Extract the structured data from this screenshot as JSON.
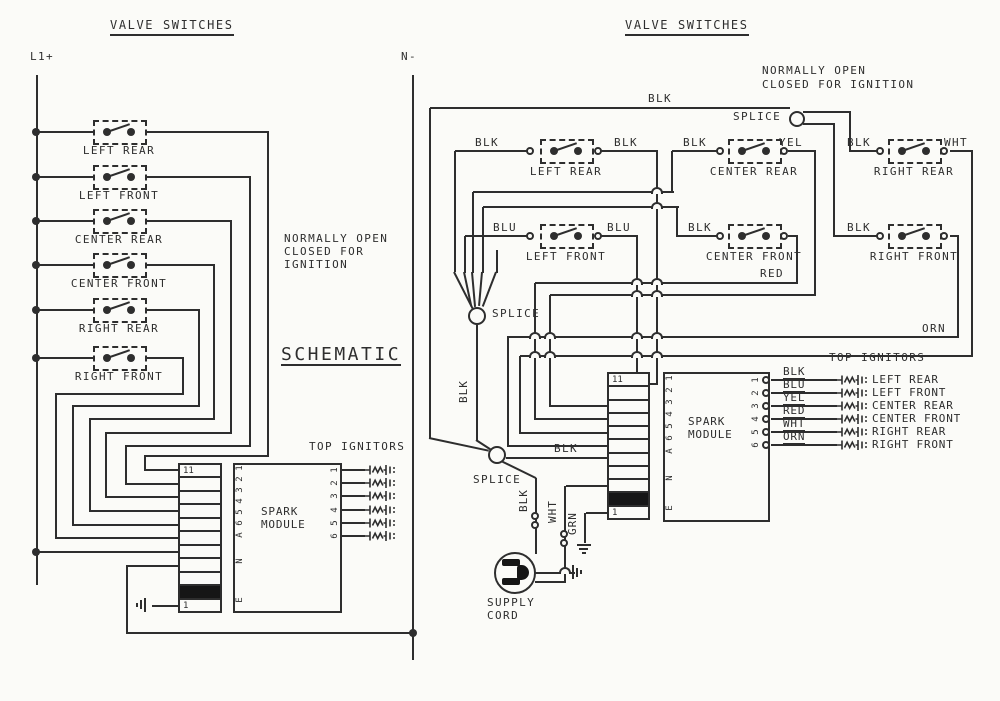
{
  "colors": {
    "line": "#2e2e2e",
    "background": "#fbfbf8",
    "connector_block": "#161616"
  },
  "left": {
    "title": "VALVE SWITCHES",
    "rail_left": "L1+",
    "rail_right": "N-",
    "switches": [
      "LEFT REAR",
      "LEFT FRONT",
      "CENTER REAR",
      "CENTER FRONT",
      "RIGHT REAR",
      "RIGHT FRONT"
    ],
    "note": [
      "NORMALLY OPEN",
      "CLOSED FOR",
      "IGNITION"
    ],
    "heading": "SCHEMATIC",
    "top_ignitors": "TOP IGNITORS",
    "connector": {
      "top": "11",
      "bottom": "1"
    },
    "module": {
      "line1": "SPARK",
      "line2": "MODULE",
      "pins_left": [
        "1",
        "2",
        "3",
        "4",
        "5",
        "6",
        "A",
        "N",
        "E"
      ],
      "pins_right": [
        "1",
        "2",
        "3",
        "4",
        "5",
        "6"
      ]
    }
  },
  "right": {
    "title": "VALVE SWITCHES",
    "note": [
      "NORMALLY OPEN",
      "CLOSED FOR IGNITION"
    ],
    "splice_label": "SPLICE",
    "switches": [
      {
        "name": "LEFT REAR",
        "left_wire": "BLK",
        "right_wire": "BLK"
      },
      {
        "name": "CENTER REAR",
        "left_wire": "BLK",
        "right_wire": "YEL"
      },
      {
        "name": "RIGHT REAR",
        "left_wire": "BLK",
        "right_wire": "WHT"
      },
      {
        "name": "LEFT FRONT",
        "left_wire": "BLU",
        "right_wire": "BLU"
      },
      {
        "name": "CENTER FRONT",
        "left_wire": "BLK",
        "right_wire": "RED"
      },
      {
        "name": "RIGHT FRONT",
        "left_wire": "BLK",
        "right_wire": "ORN"
      }
    ],
    "wire_labels": {
      "main": "BLK",
      "splice_link": "BLK",
      "to_module": "BLK",
      "to_supply": "BLK",
      "supply_white": "WHT",
      "supply_ground": "GRN"
    },
    "top_ignitors": "TOP IGNITORS",
    "connector": {
      "top": "11",
      "bottom": "1"
    },
    "module": {
      "line1": "SPARK",
      "line2": "MODULE",
      "pins_left": [
        "1",
        "2",
        "3",
        "4",
        "5",
        "6",
        "A",
        "N",
        "E"
      ],
      "pins_right": [
        "1",
        "2",
        "3",
        "4",
        "5",
        "6"
      ]
    },
    "ignitors": [
      {
        "wire": "BLK",
        "name": "LEFT REAR"
      },
      {
        "wire": "BLU",
        "name": "LEFT FRONT"
      },
      {
        "wire": "YEL",
        "name": "CENTER REAR"
      },
      {
        "wire": "RED",
        "name": "CENTER FRONT"
      },
      {
        "wire": "WHT",
        "name": "RIGHT REAR"
      },
      {
        "wire": "ORN",
        "name": "RIGHT FRONT"
      }
    ],
    "supply": [
      "SUPPLY",
      "CORD"
    ]
  }
}
